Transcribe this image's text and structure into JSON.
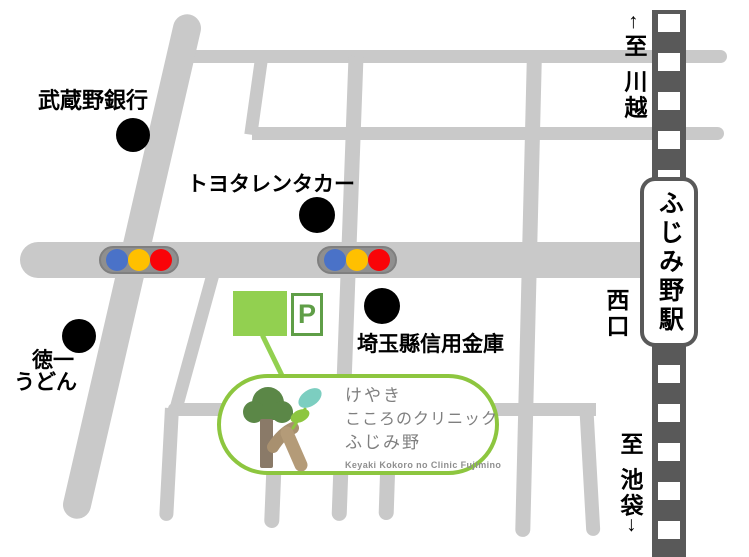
{
  "landmarks": {
    "musashino_bank": "武蔵野銀行",
    "toyota_rentacar": "トヨタレンタカー",
    "saitama_shinkin": "埼玉縣信用金庫",
    "tokuichi_line1": "徳一",
    "tokuichi_line2": "うどん"
  },
  "station": {
    "name": "ふじみ野駅",
    "west_exit": "西口"
  },
  "directions": {
    "north_arrow": "↑",
    "north": "至 川越",
    "south": "至 池袋",
    "south_arrow": "↓"
  },
  "parking": {
    "label": "P"
  },
  "clinic": {
    "line1": "けやき",
    "line2": "こころのクリニック",
    "line3": "ふじみ野",
    "name_en": "Keyaki Kokoro no Clinic Fujimino"
  },
  "traffic_signals": {
    "count": 2,
    "lamp_colors": [
      "#4a72c8",
      "#ffc000",
      "#f90408"
    ]
  },
  "colors": {
    "road": "#c9c9c9",
    "railway": "#595959",
    "clinic_green": "#8dc63f",
    "building_green": "#92d050",
    "parking_green": "#5f9e47"
  }
}
